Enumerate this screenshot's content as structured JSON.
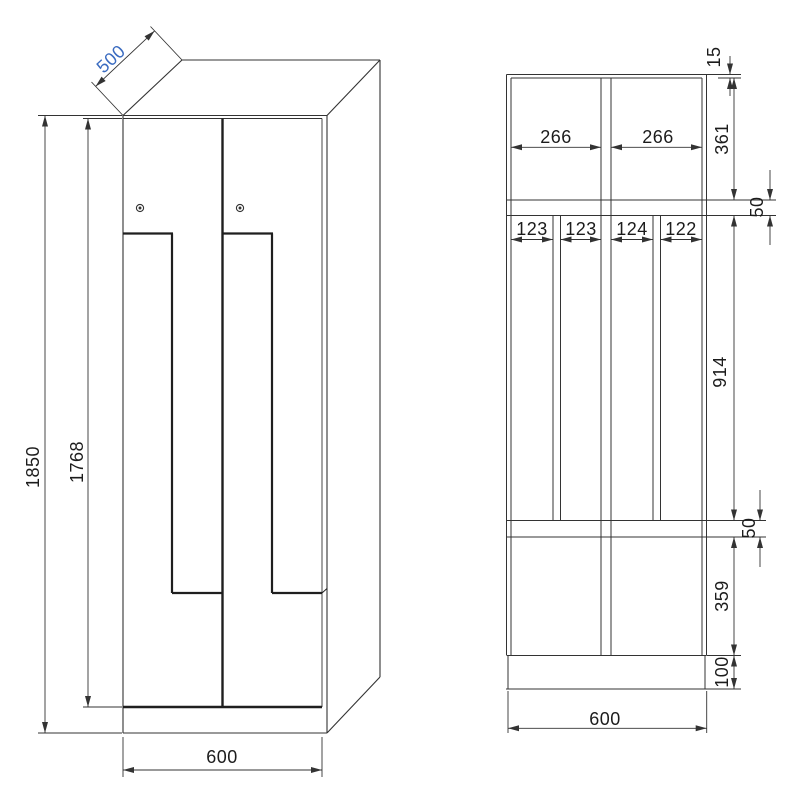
{
  "drawing": {
    "type": "technical-drawing",
    "subject": "Z-door locker cabinet: perspective view and front section view",
    "colors": {
      "line": "#333333",
      "thick_line": "#1f1f1f",
      "text": "#1c1c1c",
      "highlight_blue": "#3a6bc0"
    },
    "perspective_view": {
      "name": "perspective-view",
      "dims": {
        "depth": "500",
        "total_height": "1850",
        "door_height": "1768",
        "width": "600"
      }
    },
    "section_view": {
      "name": "front-section-view",
      "dims": {
        "top_panel": "15",
        "top_left_width": "266",
        "top_right_width": "266",
        "top_height": "361",
        "upper_shelf": "50",
        "mid_widths": [
          "123",
          "123",
          "124",
          "122"
        ],
        "mid_height": "914",
        "lower_shelf": "50",
        "bottom_height": "359",
        "plinth": "100",
        "width": "600"
      }
    }
  }
}
